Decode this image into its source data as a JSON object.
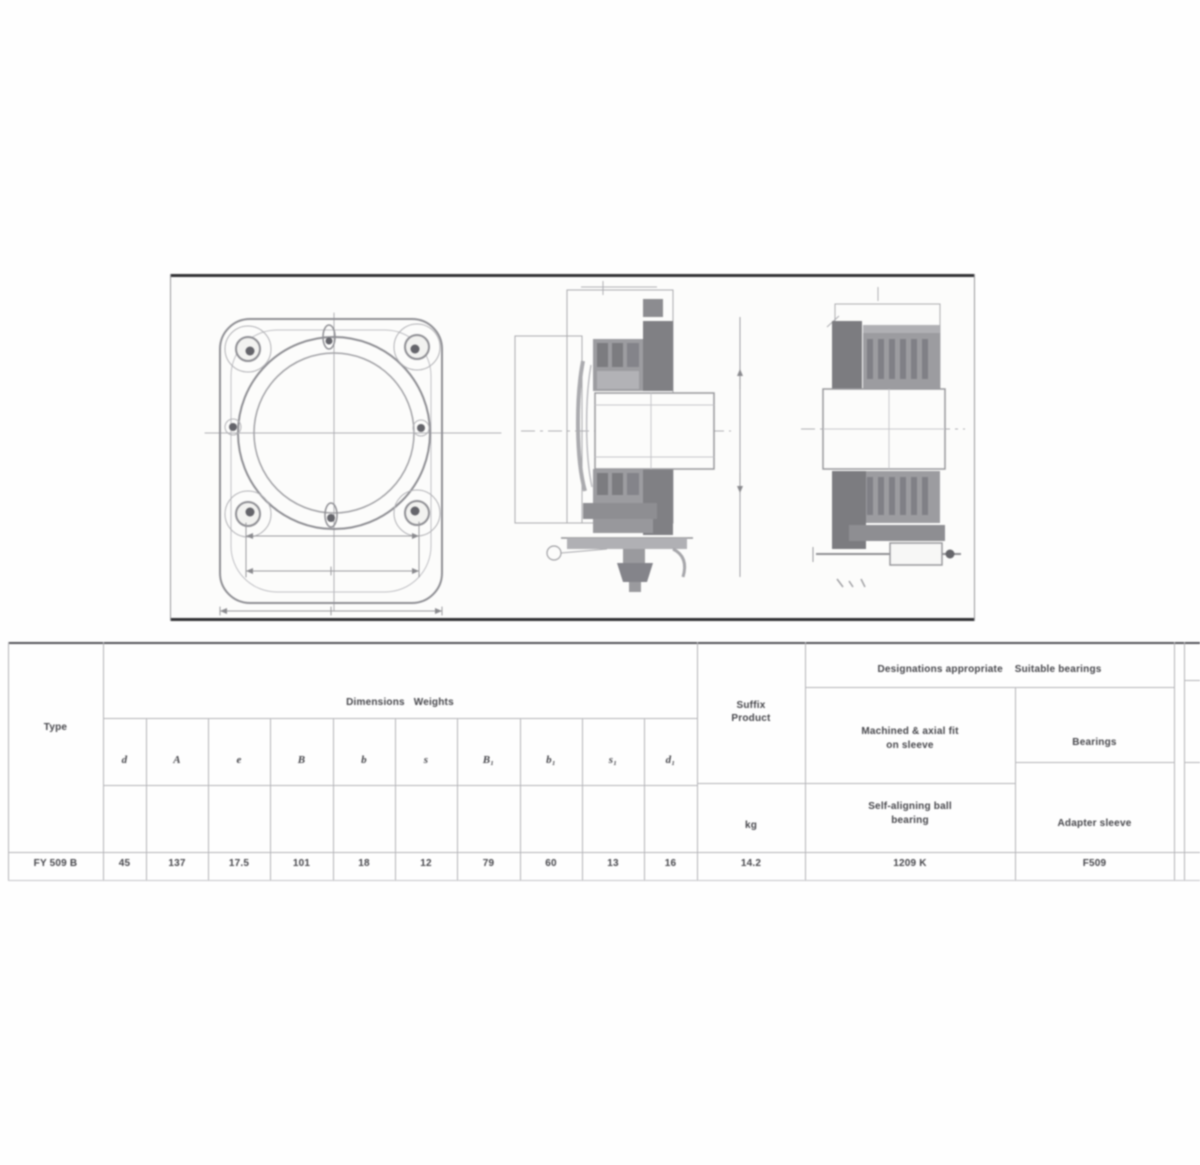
{
  "document": {
    "kind": "bearing-unit-datasheet",
    "figure_views": [
      {
        "name": "flange-front-view"
      },
      {
        "name": "unit-cross-section-view"
      },
      {
        "name": "bearing-on-adapter-sleeve-section-view"
      }
    ]
  },
  "colors": {
    "page_bg": "#ffffff",
    "panel_border": "#333336",
    "grid_line": "#b4b4b8",
    "text": "#47474c",
    "drawing_line": "#98989c",
    "section_fill": "#8a8a8e"
  },
  "table": {
    "type_col": {
      "header": "Type",
      "value": "FY 509 B"
    },
    "dimensions": {
      "group_header": "Dimensions   Weights",
      "columns": [
        "d",
        "A",
        "e",
        "B",
        "b",
        "s",
        "B₁",
        "b₁",
        "s₁",
        "d₁"
      ],
      "values": [
        "45",
        "137",
        "17.5",
        "101",
        "18",
        "12",
        "79",
        "60",
        "13",
        "16"
      ]
    },
    "mass_col": {
      "header_line1": "Suffix",
      "header_line2": "Product",
      "unit": "kg",
      "value": "14.2"
    },
    "designations": {
      "group_header": "Designations appropriate    Suitable bearings",
      "bearing_col": {
        "desc_line1": "Machined & axial fit",
        "desc_line2": "on sleeve",
        "name_line1": "Self-aligning ball",
        "name_line2": "bearing",
        "value": "1209 K"
      },
      "housing_col": {
        "desc": "Bearings",
        "name": "Adapter sleeve",
        "value": "F509"
      }
    }
  }
}
